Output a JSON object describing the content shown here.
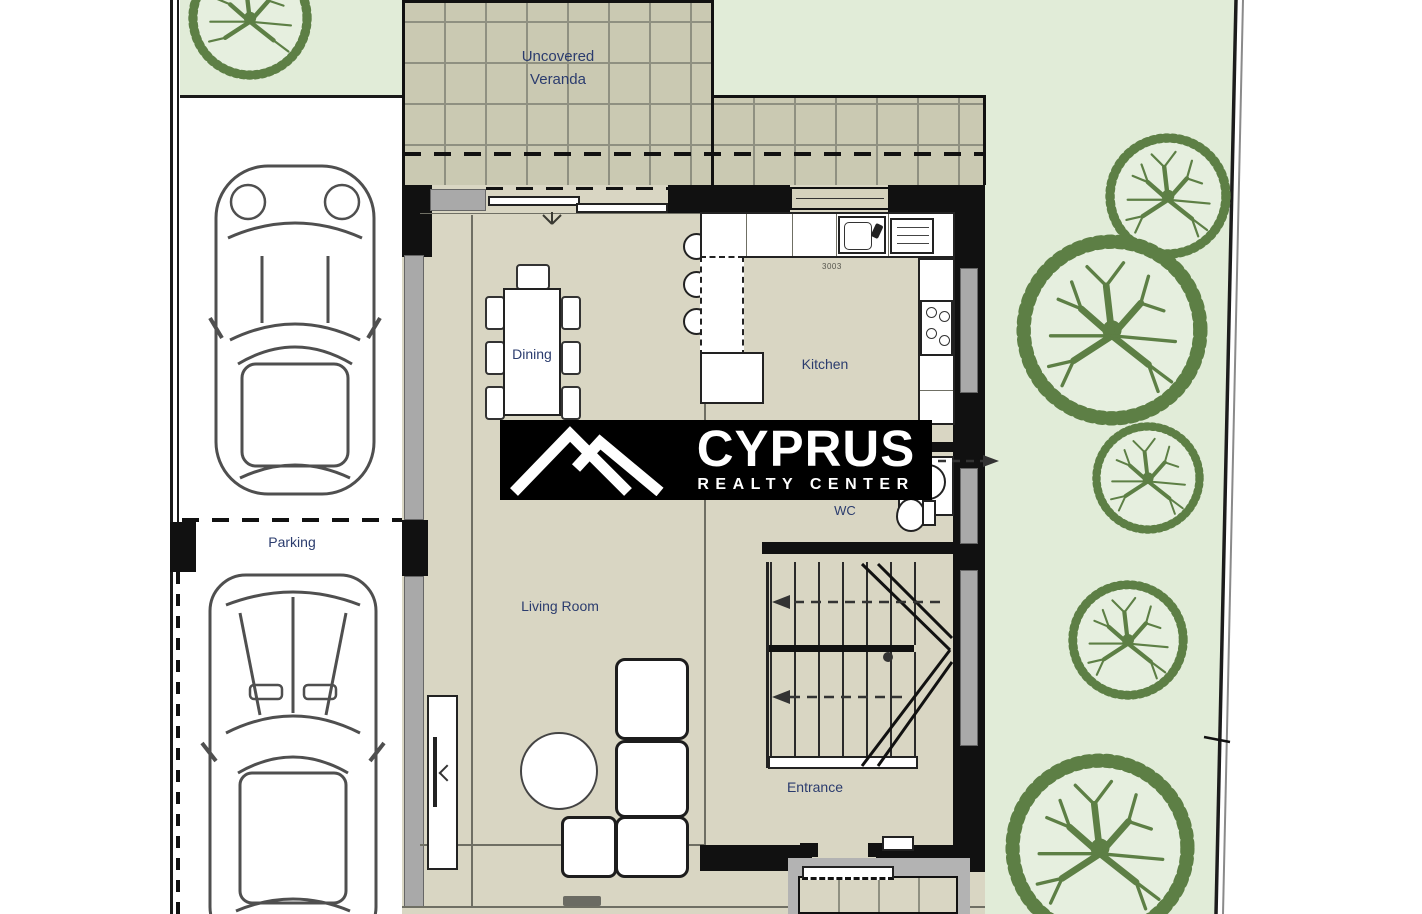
{
  "document": {
    "title": "Ground floor plan with parking and garden"
  },
  "rooms": {
    "veranda_line1": "Uncovered",
    "veranda_line2": "Veranda",
    "dining": "Dining",
    "kitchen": "Kitchen",
    "wc": "WC",
    "living_room": "Living Room",
    "entrance": "Entrance",
    "parking": "Parking"
  },
  "annotations": {
    "kitchen_dim": "3003"
  },
  "logo": {
    "title": "CYPRUS",
    "subtitle": "REALTY CENTER"
  },
  "colors": {
    "garden_green": "#e1ecd8",
    "tile_gray": "#cac9b2",
    "floor_beige": "#d9d6c3",
    "tree_green": "#5d7f45",
    "wall_black": "#111111",
    "label_navy": "#2b3c6e",
    "logo_bg": "#000000",
    "logo_text": "#ffffff"
  }
}
